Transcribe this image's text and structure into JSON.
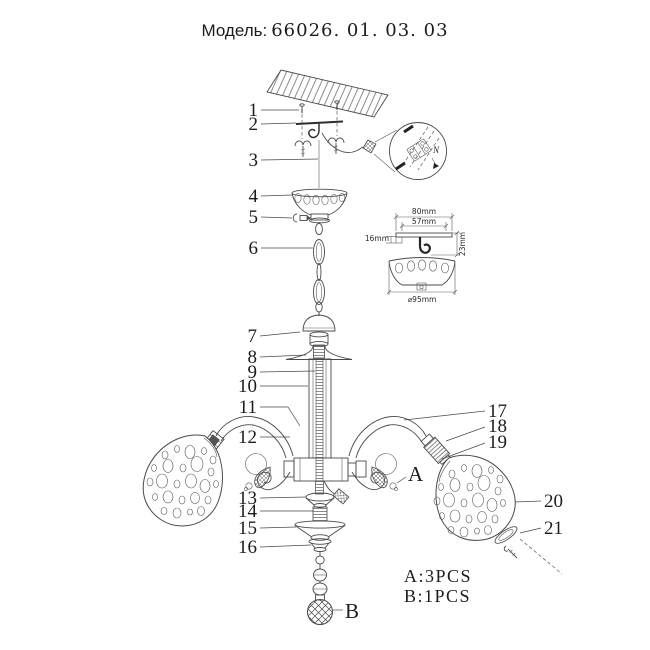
{
  "title": {
    "label": "Модель:",
    "value": "66026. 01. 03. 03"
  },
  "callouts": [
    "1",
    "2",
    "3",
    "4",
    "5",
    "6",
    "7",
    "8",
    "9",
    "10",
    "11",
    "12",
    "13",
    "14",
    "15",
    "16",
    "17",
    "18",
    "19",
    "20",
    "21"
  ],
  "letters": {
    "a": "A",
    "b": "B"
  },
  "legend": {
    "a_count": "A:3PCS",
    "b_count": "B:1PCS"
  },
  "dimensions": {
    "outer_width": "80mm",
    "inner_width": "57mm",
    "left_height": "16mm",
    "right_height": "23mm",
    "canopy_diameter": "⌀95mm"
  },
  "wiring_detail": {
    "neutral_label": "N"
  },
  "colors": {
    "line": "#4a4a4a",
    "text": "#1c1c1c",
    "background": "#ffffff"
  }
}
